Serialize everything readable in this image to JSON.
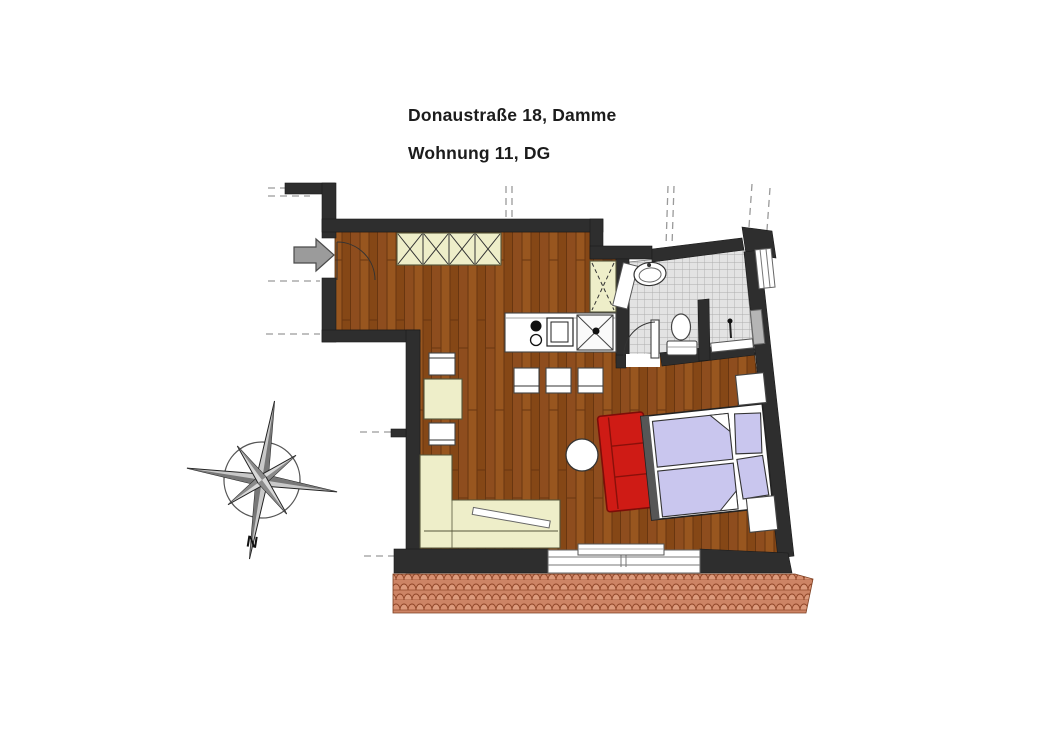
{
  "title": {
    "line1": "Donaustraße 18, Damme",
    "line2": "Wohnung 11, DG"
  },
  "compass": {
    "north_label": "N"
  },
  "colors": {
    "wall": "#2e2e2e",
    "wood_floor": "#8e4d1e",
    "furniture_cream": "#eeeec9",
    "bed_linen": "#c9c6ee",
    "sofa_red": "#cf1b15",
    "bath_tile": "#e3e3e3",
    "roof_tile": "#d2876a",
    "entrance_arrow": "#9b9b9b"
  }
}
